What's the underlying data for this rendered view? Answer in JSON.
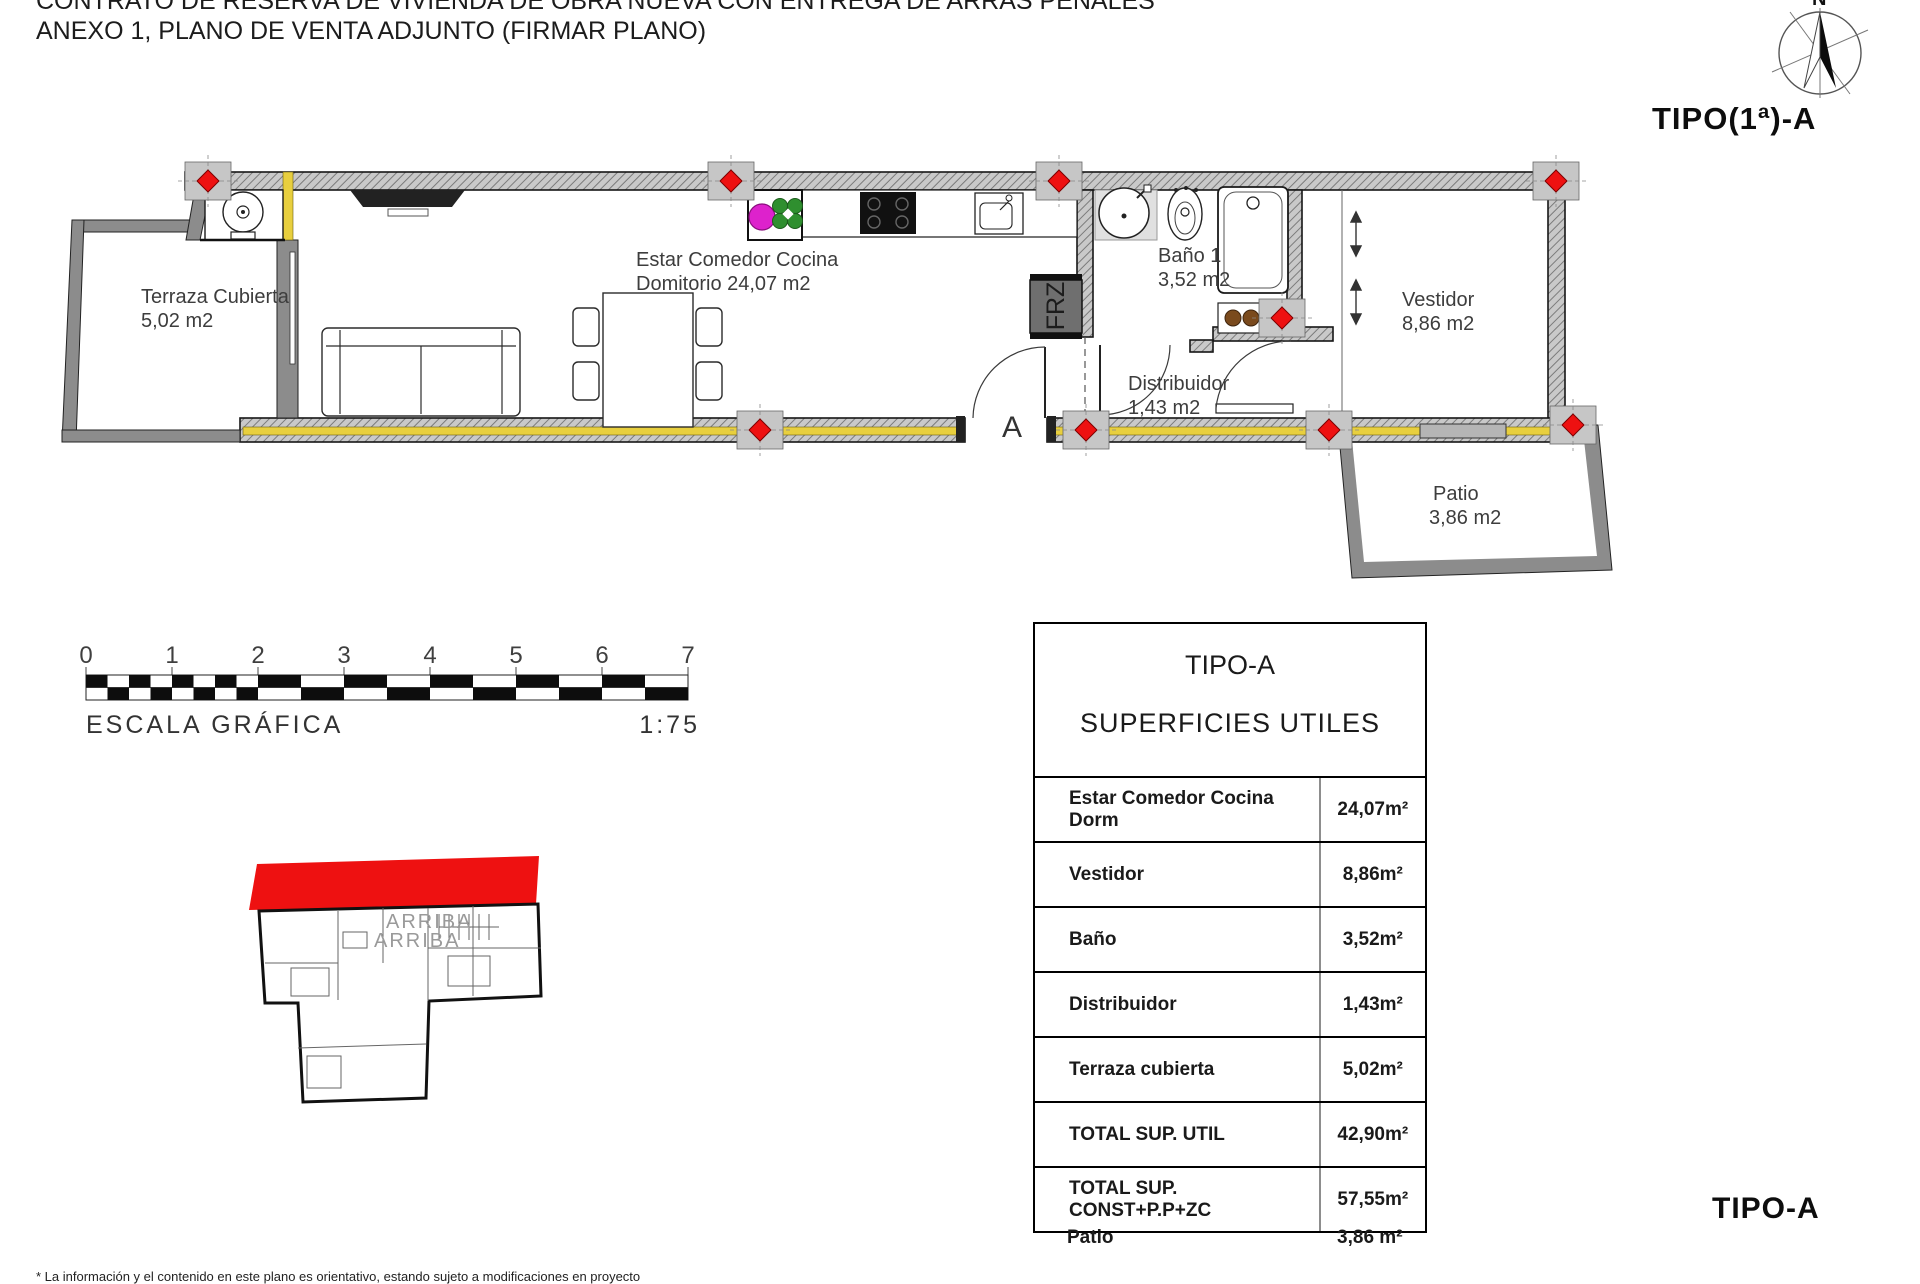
{
  "document": {
    "title_line1": "CONTRATO DE RESERVA DE VIVIENDA DE OBRA NUEVA CON ENTREGA DE ARRAS PENALES",
    "title_line2": "ANEXO 1, PLANO DE VENTA ADJUNTO (FIRMAR PLANO)",
    "disclaimer": "* La información y el contenido en este plano es orientativo, estando sujeto a modificaciones en proyecto",
    "type_label_top": "TIPO(1ª)-A",
    "type_label_bottom": "TIPO-A"
  },
  "compass": {
    "north": "N"
  },
  "floor_plan": {
    "rooms": {
      "terraza": {
        "name": "Terraza Cubierta",
        "area": "5,02 m2"
      },
      "estar": {
        "name": "Estar Comedor Cocina",
        "area": "Domitorio 24,07 m2"
      },
      "bano": {
        "name": "Baño 1",
        "area": "3,52 m2"
      },
      "distribuidor": {
        "name": "Distribuidor",
        "area": "1,43 m2"
      },
      "vestidor": {
        "name": "Vestidor",
        "area": "8,86 m2"
      },
      "patio": {
        "name": "Patio",
        "area": "3,86 m2"
      }
    },
    "labels": {
      "freezer": "FRZ",
      "section": "A"
    },
    "colors": {
      "marker_red": "#ee1111",
      "wall_yellow": "#e8cf3e",
      "plant_green": "#2f8f2f",
      "decor_magenta": "#dd22cc",
      "knob_brown": "#7a4a1d"
    }
  },
  "scale_bar": {
    "ticks": [
      "0",
      "1",
      "2",
      "3",
      "4",
      "5",
      "6",
      "7"
    ],
    "caption": "ESCALA GRÁFICA",
    "ratio": "1:75"
  },
  "key_plan": {
    "stair_label_1": "ARRIBA",
    "stair_label_2": "ARRIBA",
    "highlight_color": "#ee1111"
  },
  "area_table": {
    "title": "TIPO-A",
    "subtitle": "SUPERFICIES UTILES",
    "rows": [
      {
        "label": "Estar Comedor Cocina Dorm",
        "value": "24,07m²"
      },
      {
        "label": "Vestidor",
        "value": "8,86m²"
      },
      {
        "label": "Baño",
        "value": "3,52m²"
      },
      {
        "label": "Distribuidor",
        "value": "1,43m²"
      },
      {
        "label": "Terraza cubierta",
        "value": "5,02m²"
      },
      {
        "label": "TOTAL SUP. UTIL",
        "value": "42,90m²"
      },
      {
        "label": "TOTAL SUP. CONST+P.P+ZC",
        "value": "57,55m²"
      }
    ],
    "extra_row": {
      "label": "Patio",
      "value": "3,86 m²"
    }
  }
}
